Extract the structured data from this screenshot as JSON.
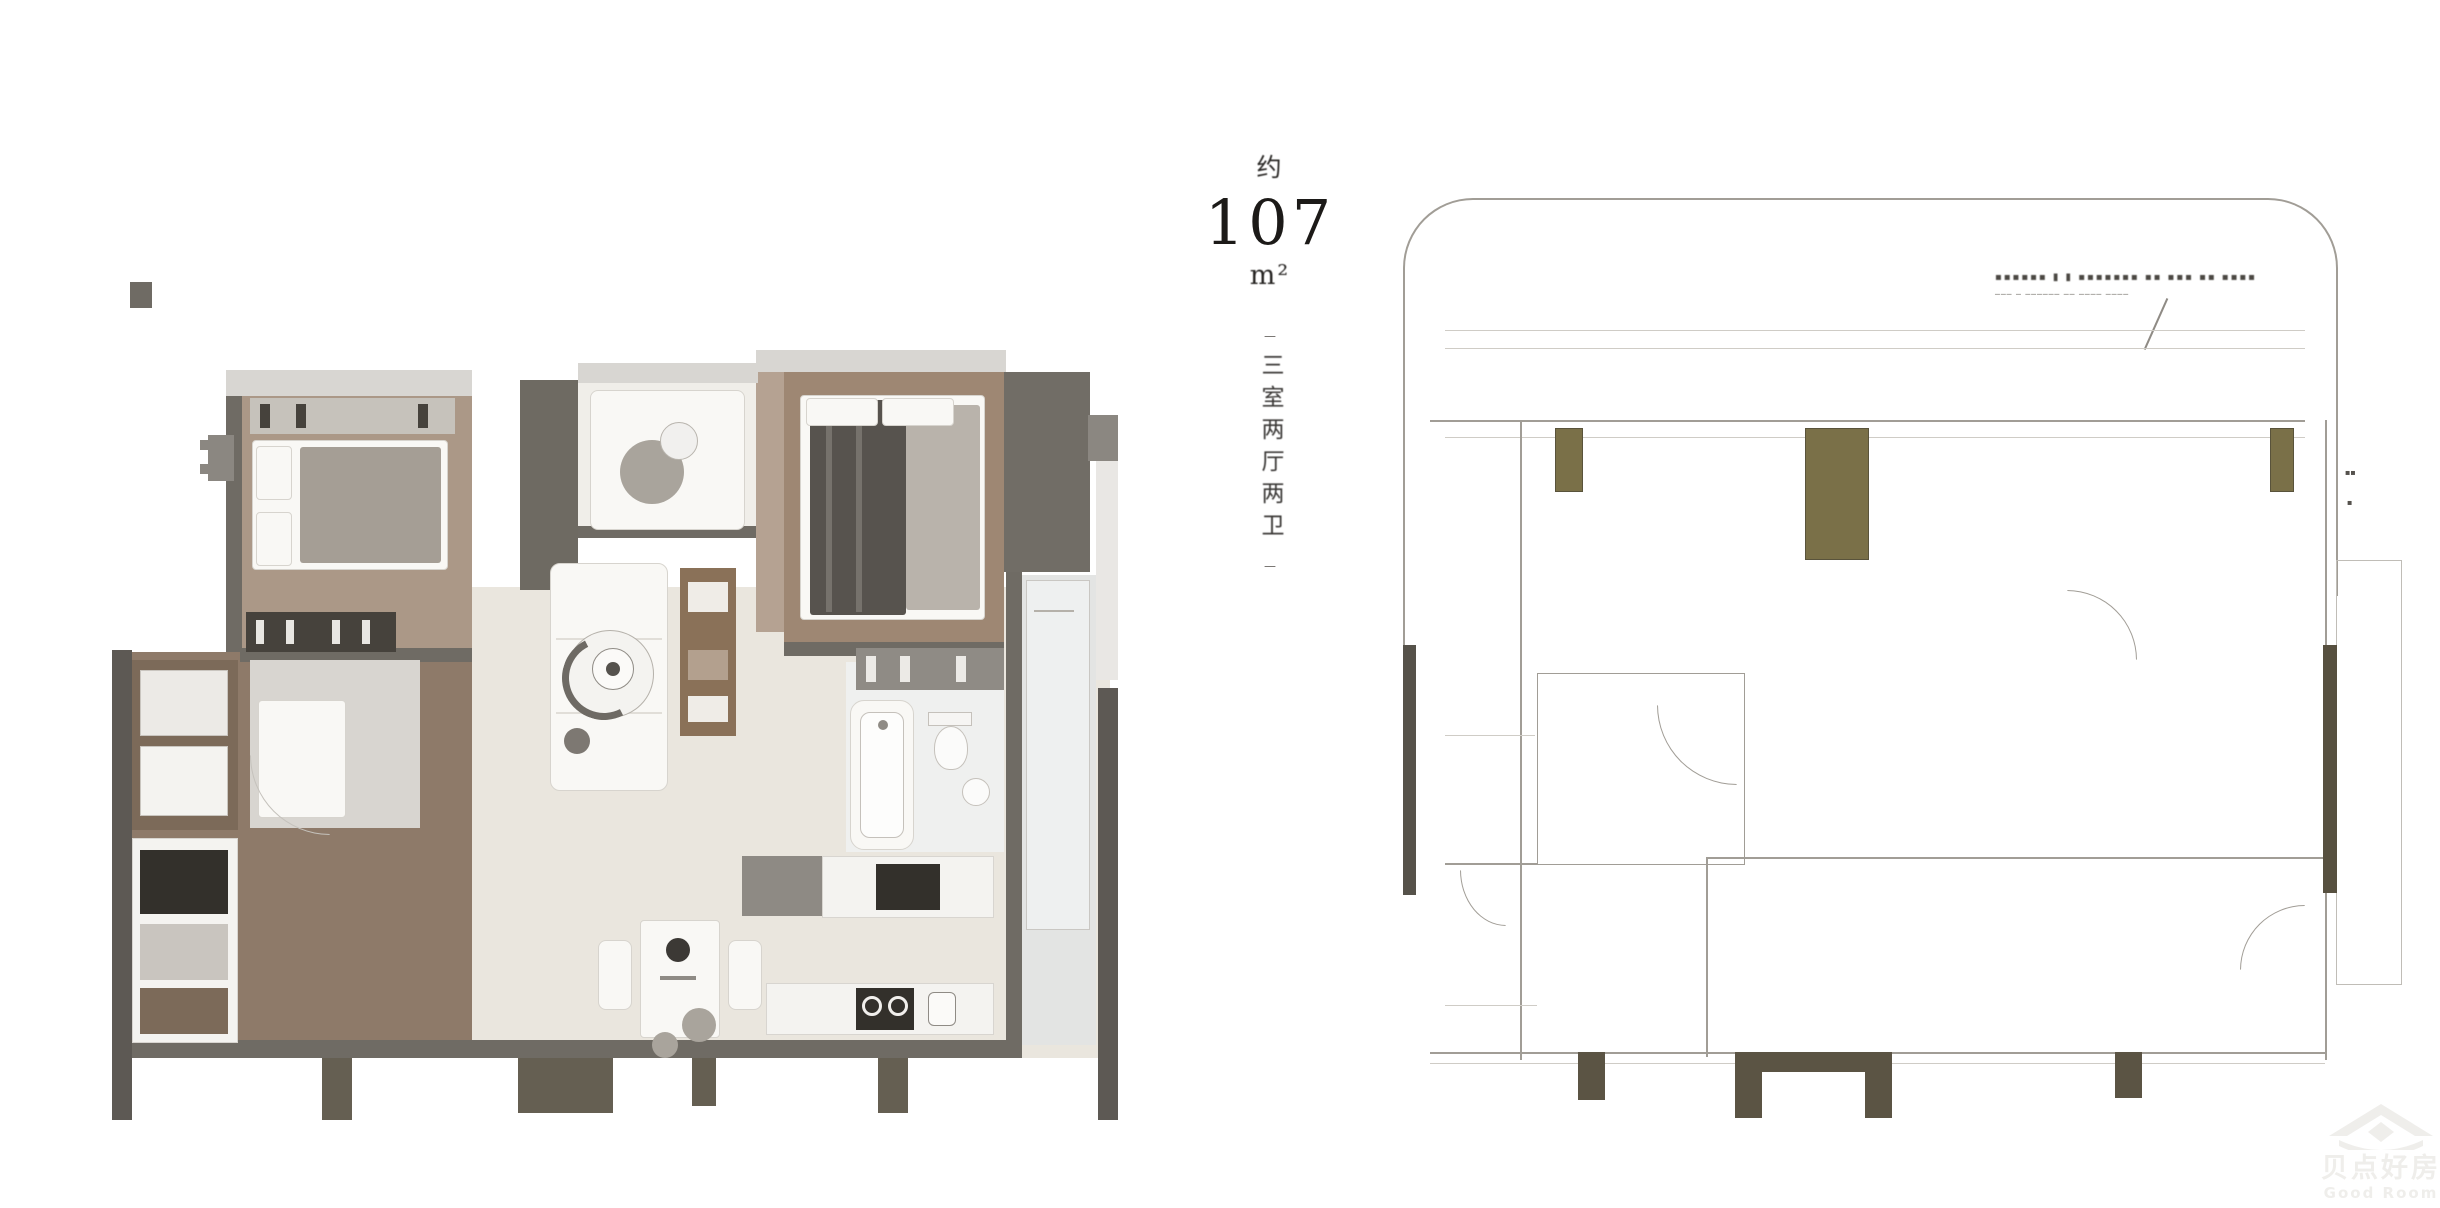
{
  "area_label": {
    "qualifier": "约",
    "value": "107",
    "unit": "m²"
  },
  "type_label": {
    "tick_top": "—",
    "text": "三室两厅两卫",
    "tick_bottom": "—"
  },
  "right_plan": {
    "annotation_marks": "▪▪▪▪▪▪  ▮ ▮  ▪▪▪▪▪▪▪  ▪▪ ▪▪▪ ▪▪ ▪▪▪▪",
    "annotation_dashes": "───  ─  ──────  ── ────  ────",
    "tick_right_upper": "▪▪",
    "tick_right_lower": "▪"
  },
  "watermark": {
    "zh": "贝点好房",
    "en": "Good Room"
  },
  "palette": {
    "ink": "#1c1a18",
    "label": "#3b3937",
    "frame": "#d8d6d2",
    "wall": "#6f6b64",
    "wallDark": "#5d5954",
    "stub": "#655f52",
    "floorA": "#ab9887",
    "floorB": "#9e8773",
    "floorK": "#8e7a69",
    "floorL": "#eae6de",
    "balcony": "#f0eee9",
    "closet": "#6e6a62",
    "blockR": "#716d66",
    "white": "#f9f8f5",
    "duvet": "#a59e95",
    "duvetDark": "#57534e",
    "blanket": "#b9b3ab",
    "shelfDark": "#46423c",
    "shelf": "#8f8b85",
    "counter": "#f4f3f0",
    "appliance": "#33302b",
    "cabinet": "#7c6a59",
    "corridor": "#e3e4e3",
    "panel": "#eef0f0",
    "fin": "#e9e7e4",
    "lineMain": "#a19d96",
    "lineSoft": "#cfccc6",
    "olive": "#7a7048",
    "oliveBorder": "#59533b",
    "barL": "#56524a",
    "barR": "#57503f",
    "rpStub": "#5b5444",
    "grayBlob": "#a9a49c",
    "tv": "#8a7158",
    "wm": "#efeeeb"
  }
}
